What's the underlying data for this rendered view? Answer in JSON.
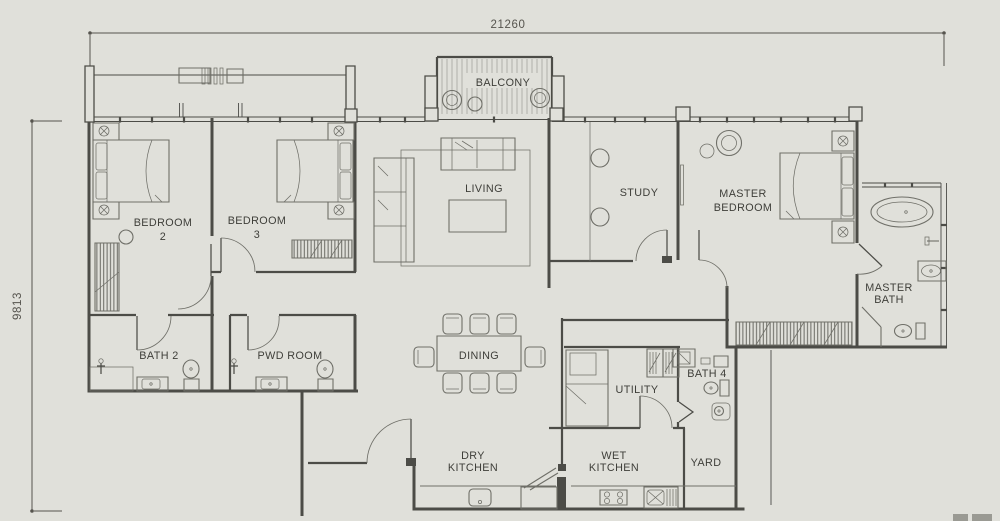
{
  "plan": {
    "title": "apartment-floor-plan",
    "dimensions": {
      "width": "21260",
      "height": "9813"
    },
    "labels": {
      "balcony": "BALCONY",
      "living": "LIVING",
      "study": "STUDY",
      "master_bedroom_1": "MASTER",
      "master_bedroom_2": "BEDROOM",
      "bedroom2_1": "BEDROOM",
      "bedroom2_2": "2",
      "bedroom3_1": "BEDROOM",
      "bedroom3_2": "3",
      "master_bath_1": "MASTER",
      "master_bath_2": "BATH",
      "bath2": "BATH 2",
      "pwd": "PWD ROOM",
      "dining": "DINING",
      "utility": "UTILITY",
      "bath4": "BATH 4",
      "dry_kitchen_1": "DRY",
      "dry_kitchen_2": "KITCHEN",
      "wet_kitchen_1": "WET",
      "wet_kitchen_2": "KITCHEN",
      "yard": "YARD"
    },
    "colors": {
      "background": "#e0e0da",
      "wall": "#4c4c47",
      "furniture": "#6f6f68",
      "text": "#3e3e39"
    }
  }
}
